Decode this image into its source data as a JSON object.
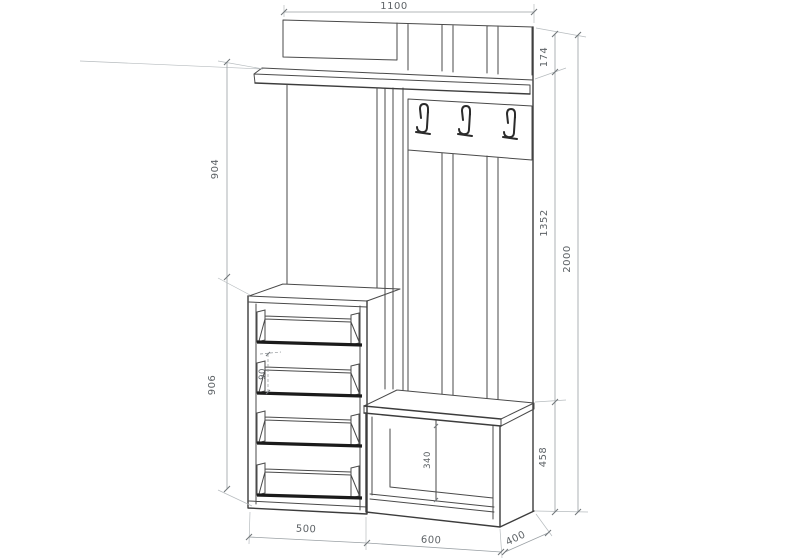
{
  "drawing": {
    "kind": "furniture assembly dimension drawing — hallway set (wall shelf, coat-hook panel, open shoe cabinet, bench)",
    "dimensions": {
      "overall_width": "1100",
      "top_panel_height": "174",
      "hook_section_height": "1352",
      "overall_height": "2000",
      "bench_section_height": "458",
      "upper_section_height": "904",
      "cabinet_section_height": "906",
      "cabinet_width": "500",
      "bench_width": "600",
      "unit_depth": "400",
      "shelf_side_height": "90",
      "bench_opening_height": "340"
    },
    "components": {
      "coat_hooks_count": 3,
      "shoe_shelves_count": 4,
      "back_slats_count": 3,
      "bench_compartments": 2
    },
    "colors": {
      "background": "#ffffff",
      "outline": "#4a4a4a",
      "shelf_front_rail": "#1b1b1b",
      "dimension_lines": "#9aa0a4",
      "dimension_text": "#5d6266"
    }
  }
}
